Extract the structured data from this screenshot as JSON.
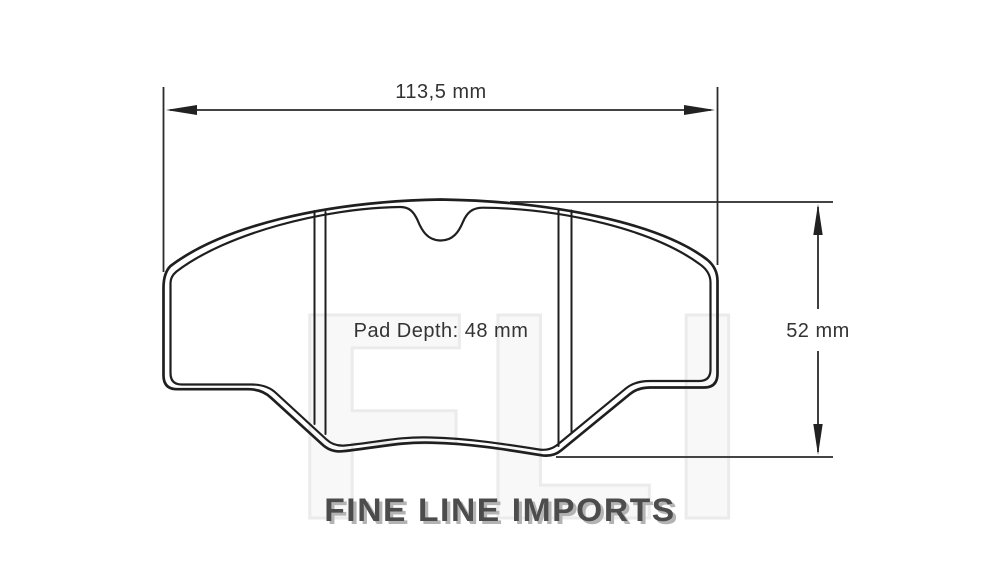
{
  "drawing": {
    "width_dimension": "113,5 mm",
    "height_dimension": "52 mm",
    "pad_depth_label": "Pad Depth: 48 mm",
    "part_type": "brake-pad-outline"
  },
  "branding": {
    "logo_text": "FINE LINE IMPORTS",
    "watermark_text": "FLI"
  },
  "colors": {
    "background": "#ffffff",
    "drawing_line": "#1f1f1f",
    "dimension_line": "#2a2a2a",
    "dimension_text": "#333333",
    "logo_face": "#4c4c4c",
    "logo_shadow": "#b3b3b3",
    "watermark_stroke": "#ebebeb"
  }
}
